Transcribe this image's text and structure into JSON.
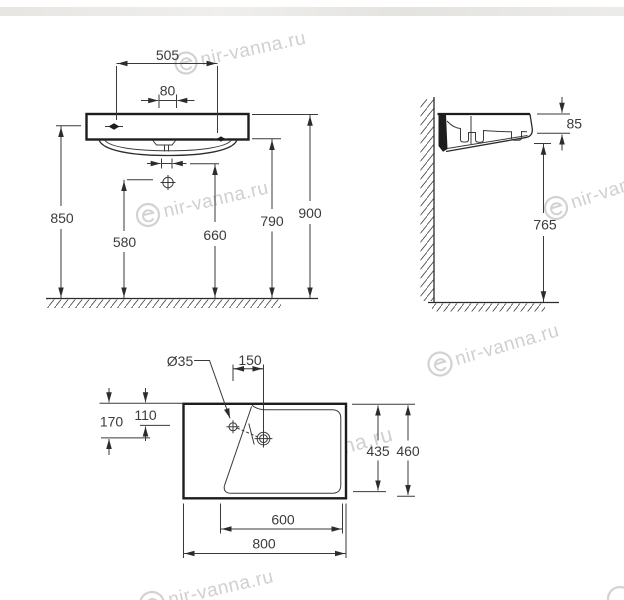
{
  "watermark": {
    "text": "nir-vanna.ru"
  },
  "colors": {
    "line": "#2c2c2c",
    "thick_line": "#1d1d1d",
    "dim_text": "#3b3b3b",
    "watermark": "#c5c5c5",
    "top_band": "#e6e4e1",
    "background": "#ffffff"
  },
  "views": {
    "front": {
      "d505": "505",
      "d80": "80",
      "d850": "850",
      "d580": "580",
      "d660": "660",
      "d790": "790",
      "d900": "900"
    },
    "side": {
      "d85": "85",
      "d765": "765"
    },
    "plan": {
      "hole_dia": "Ø35",
      "d150": "150",
      "d110": "110",
      "d170": "170",
      "d435": "435",
      "d460": "460",
      "d600": "600",
      "d800": "800"
    }
  }
}
